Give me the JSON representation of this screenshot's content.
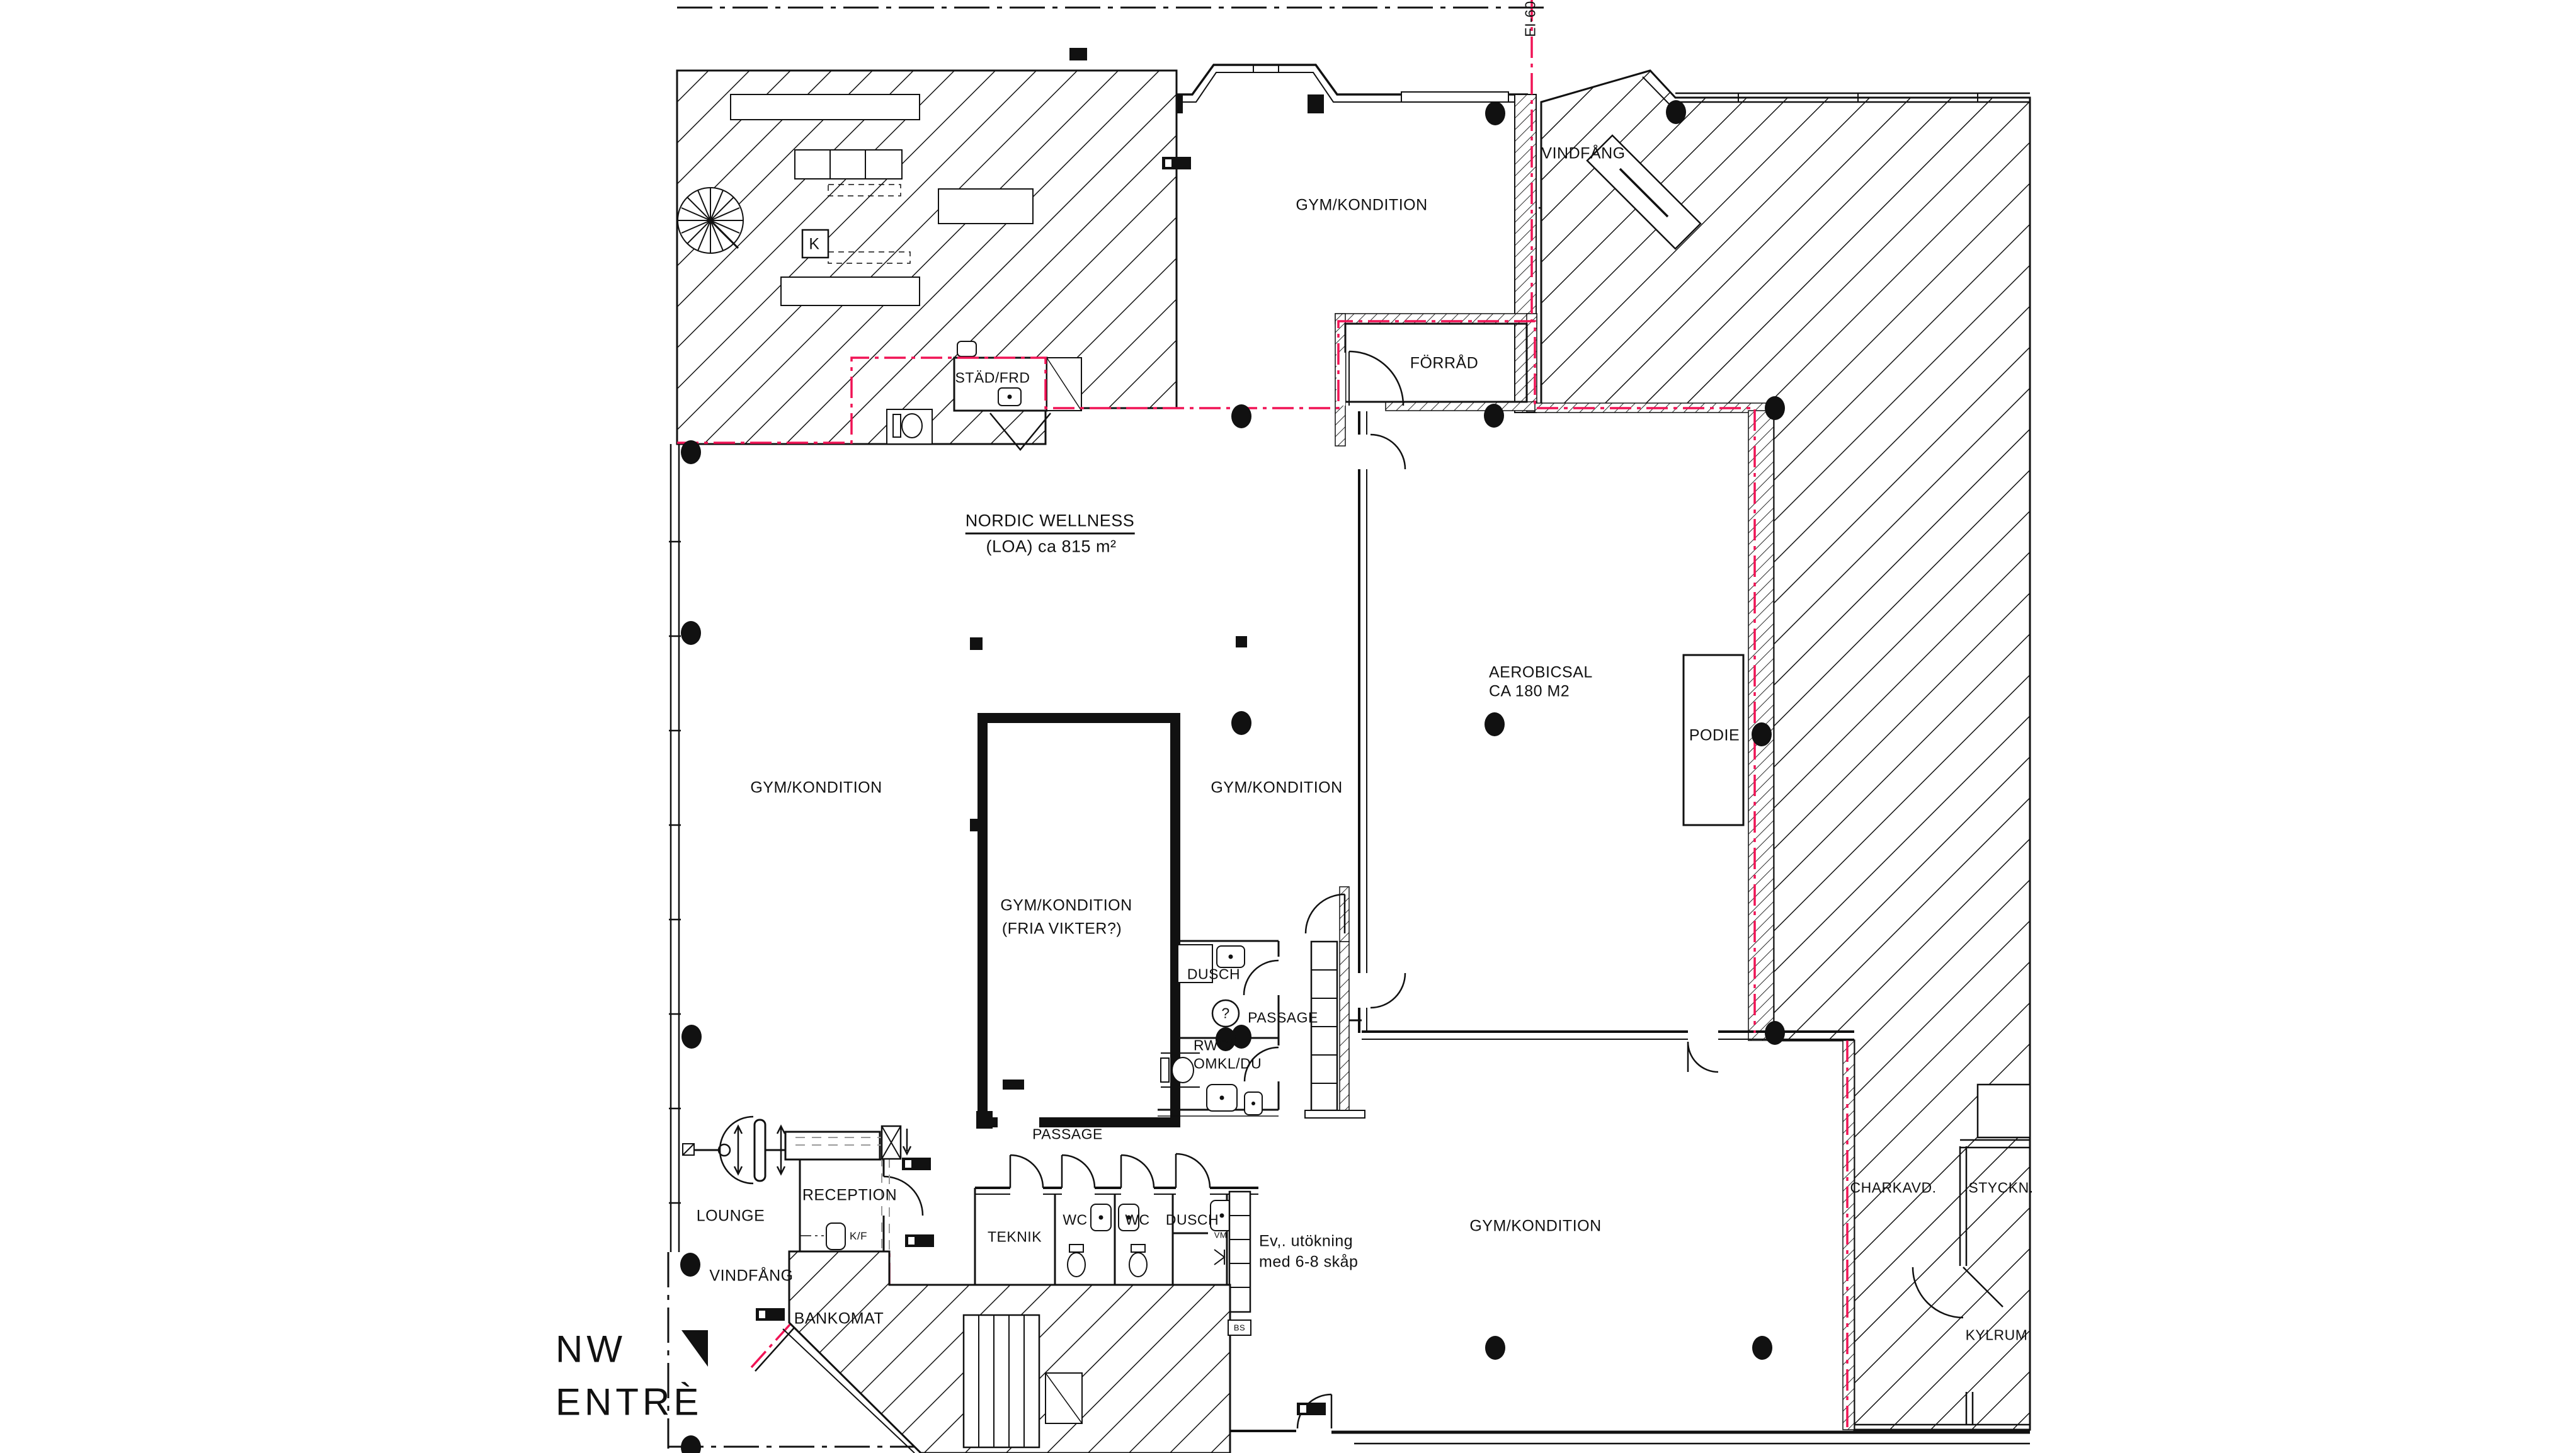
{
  "colors": {
    "line": "#111111",
    "fire_boundary_red": "#f01355",
    "background": "#ffffff"
  },
  "labels": {
    "ei60": "EI-60",
    "vindfang_top": "VINDFÅNG",
    "gym_top": "GYM/KONDITION",
    "forrad": "FÖRRÅD",
    "stad_frd": "STÄD/FRD",
    "k_box": "K",
    "nordic_wellness": "NORDIC WELLNESS",
    "loa": "(LOA) ca 815 m²",
    "aerobicsal_line1": "AEROBICSAL",
    "aerobicsal_line2": "CA 180 M2",
    "podie": "PODIE",
    "gym_left": "GYM/KONDITION",
    "gym_center": "GYM/KONDITION",
    "fria_line1": "GYM/KONDITION",
    "fria_line2": "(FRIA VIKTER?)",
    "dusch_mid": "DUSCH",
    "passage_right": "PASSAGE",
    "rwc_line1": "RWC/",
    "rwc_line2": "OMKL/DU",
    "question_mark": "?",
    "passage_bottom": "PASSAGE",
    "teknik": "TEKNIK",
    "wc_left": "WC",
    "wc_right": "WC",
    "dusch_bottom": "DUSCH",
    "vm": "VM",
    "ev_line1": "Ev,. utökning",
    "ev_line2": "med 6-8 skåp",
    "bs": "BS",
    "gym_bottom": "GYM/KONDITION",
    "lounge": "LOUNGE",
    "reception": "RECEPTION",
    "kf": "K/F",
    "vindfang_left": "VINDFÅNG",
    "bankomat": "BANKOMAT",
    "nw_line1": "NW",
    "nw_line2": "ENTRÈ",
    "charkavd": "CHARKAVD.",
    "styckn": "STYCKN.",
    "kylrum": "KYLRUM"
  }
}
